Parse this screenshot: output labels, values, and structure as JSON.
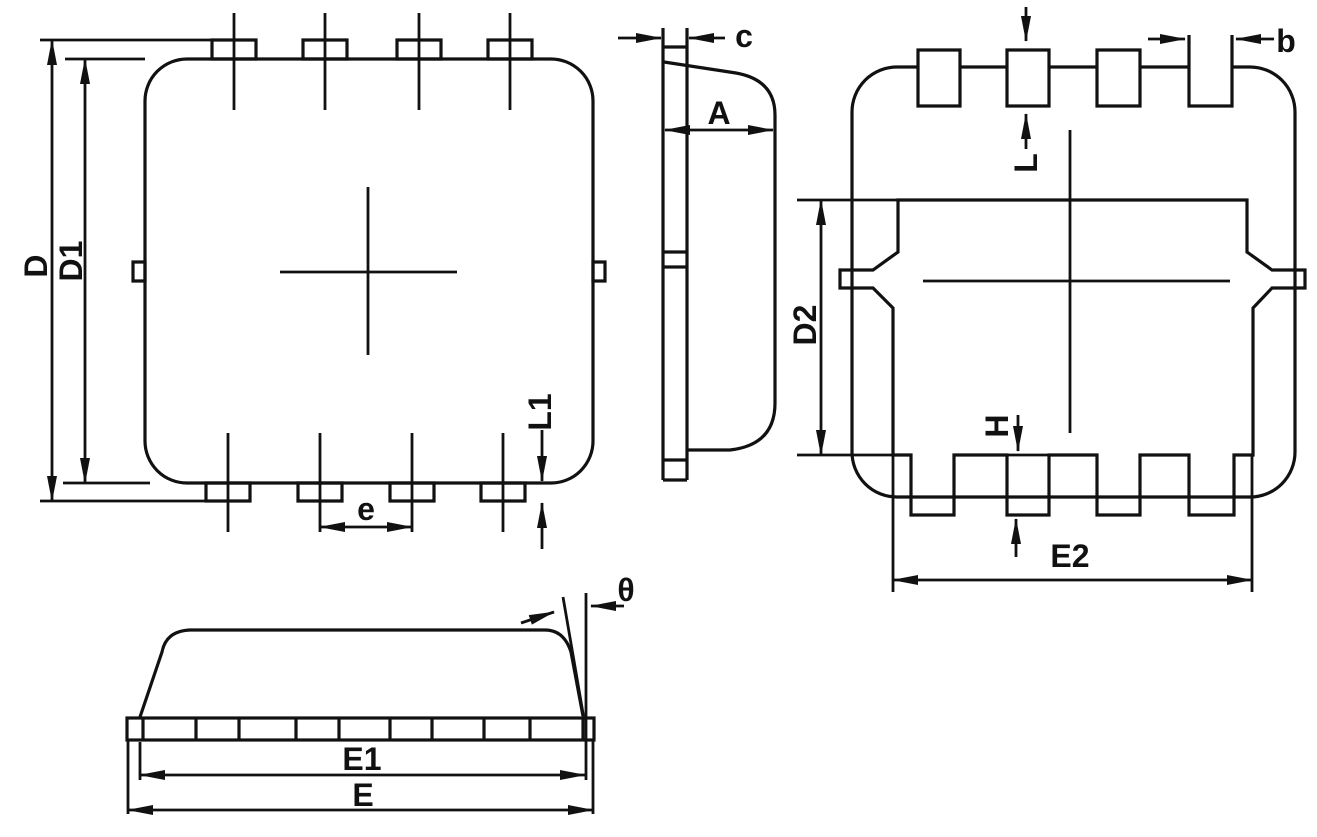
{
  "drawing": {
    "type": "ic-package-outline-drawing",
    "colors": {
      "line": "#111111",
      "background": "#ffffff"
    },
    "views": {
      "top": {
        "name": "top view",
        "labels": {
          "d": "D",
          "d1": "D1",
          "l1": "L1",
          "e": "e"
        }
      },
      "side": {
        "name": "side profile view",
        "labels": {
          "c": "c",
          "a": "A"
        }
      },
      "back": {
        "name": "bottom pad view",
        "labels": {
          "b": "b",
          "l": "L",
          "d2": "D2",
          "h": "H",
          "e2": "E2"
        }
      },
      "front": {
        "name": "front elevation view",
        "labels": {
          "theta": "θ",
          "e1": "E1",
          "e": "E"
        }
      }
    }
  }
}
